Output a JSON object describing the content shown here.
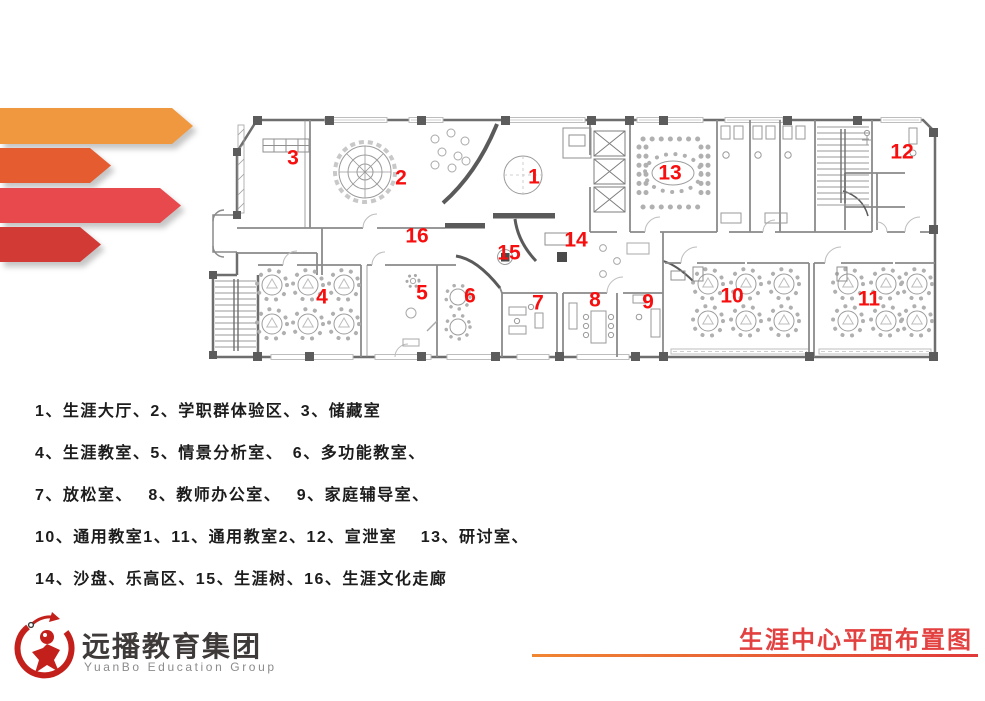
{
  "page": {
    "background": "#ffffff"
  },
  "decoration": {
    "arrows": [
      {
        "name": "ribbon-orange",
        "color": "#F0983F",
        "y": 108,
        "height": 36,
        "width": 193
      },
      {
        "name": "ribbon-vermilion",
        "color": "#E55C30",
        "y": 148,
        "height": 35,
        "width": 111
      },
      {
        "name": "ribbon-red",
        "color": "#E8494C",
        "y": 188,
        "height": 35,
        "width": 181
      },
      {
        "name": "ribbon-dark-red",
        "color": "#D23A36",
        "y": 227,
        "height": 35,
        "width": 101
      }
    ]
  },
  "floor_plan": {
    "marker_color": "#f70f0f",
    "rooms": [
      {
        "n": "1",
        "name": "生涯大厅",
        "x": 534,
        "y": 177
      },
      {
        "n": "2",
        "name": "学职群体验区",
        "x": 401,
        "y": 178
      },
      {
        "n": "3",
        "name": "储藏室",
        "x": 293,
        "y": 158
      },
      {
        "n": "4",
        "name": "生涯教室",
        "x": 322,
        "y": 297
      },
      {
        "n": "5",
        "name": "情景分析室",
        "x": 422,
        "y": 293
      },
      {
        "n": "6",
        "name": "多功能教室",
        "x": 470,
        "y": 296
      },
      {
        "n": "7",
        "name": "放松室",
        "x": 538,
        "y": 303
      },
      {
        "n": "8",
        "name": "教师办公室",
        "x": 595,
        "y": 300
      },
      {
        "n": "9",
        "name": "家庭辅导室",
        "x": 648,
        "y": 302
      },
      {
        "n": "10",
        "name": "通用教室1",
        "x": 732,
        "y": 296
      },
      {
        "n": "11",
        "name": "通用教室2",
        "x": 869,
        "y": 299
      },
      {
        "n": "12",
        "name": "宣泄室",
        "x": 902,
        "y": 152
      },
      {
        "n": "13",
        "name": "研讨室",
        "x": 670,
        "y": 173
      },
      {
        "n": "14",
        "name": "沙盘、乐高区",
        "x": 576,
        "y": 240
      },
      {
        "n": "15",
        "name": "生涯树",
        "x": 509,
        "y": 253
      },
      {
        "n": "16",
        "name": "生涯文化走廊",
        "x": 417,
        "y": 236
      }
    ]
  },
  "legend": {
    "lines": [
      "1、生涯大厅、2、学职群体验区、3、储藏室",
      "4、生涯教室、5、情景分析室、　6、多功能教室、",
      "7、放松室、　 8、教师办公室、　 9、家庭辅导室、",
      "10、通用教室1、11、通用教室2、12、宣泄室　 13、研讨室、",
      "14、沙盘、乐高区、15、生涯树、16、生涯文化走廊"
    ]
  },
  "footer": {
    "logo": {
      "cn": "远播教育集团",
      "en": "YuanBo Education Group",
      "icon_color": "#c4201b",
      "cn_color": "#3e3a39",
      "en_color": "#8c8c8c"
    },
    "title": {
      "text": "生涯中心平面布置图",
      "color": "#e34040",
      "underline_from": "#f08632",
      "underline_to": "#e03a3a"
    }
  }
}
